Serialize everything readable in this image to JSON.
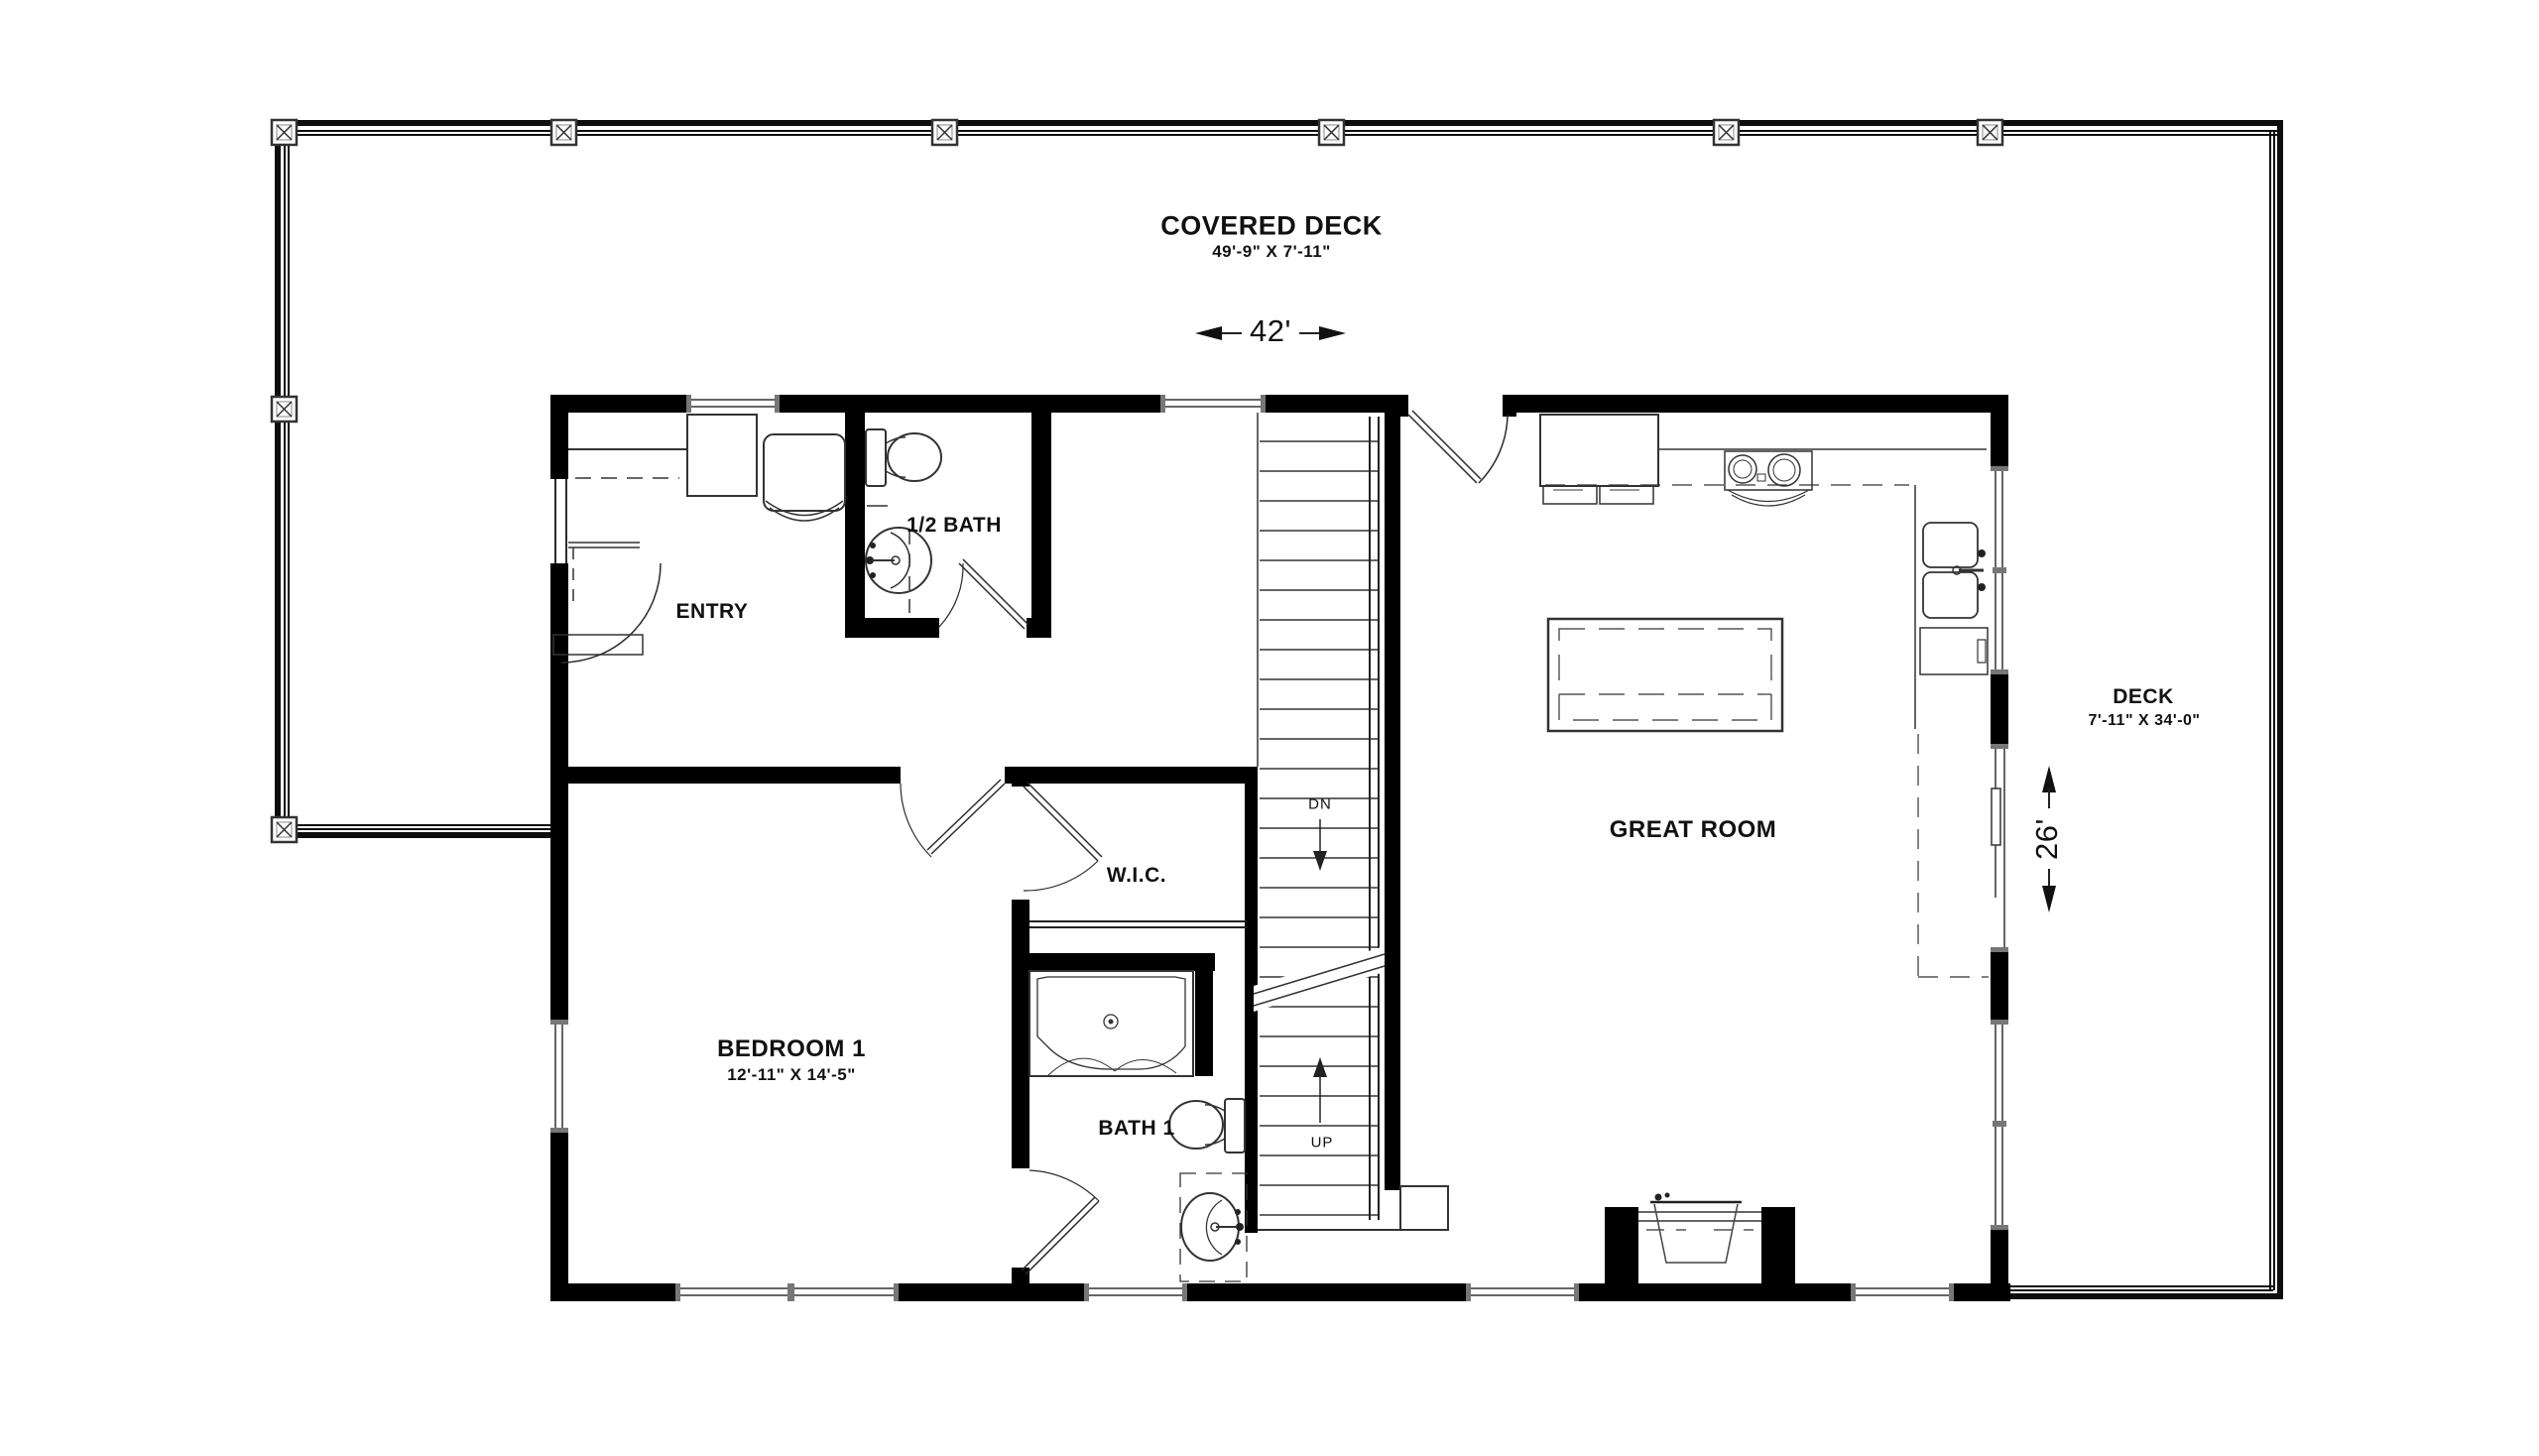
{
  "plan": {
    "title": "First floor plan",
    "labels": {
      "covered_deck": "COVERED DECK",
      "covered_deck_dims": "49'-9\" X 7'-11\"",
      "deck": "DECK",
      "deck_dims": "7'-11\" X 34'-0\"",
      "entry": "ENTRY",
      "half_bath": "1/2 BATH",
      "great_room": "GREAT ROOM",
      "wic": "W.I.C.",
      "bedroom1": "BEDROOM 1",
      "bedroom1_dims": "12'-11\" X 14'-5\"",
      "bath1": "BATH 1",
      "stairs_down": "DN",
      "stairs_up": "UP",
      "width_dim": "42'",
      "depth_dim": "26'"
    },
    "fixtures": [
      "refrigerator",
      "range",
      "kitchen-sink",
      "dishwasher",
      "kitchen-island",
      "half-bath-toilet",
      "pedestal-sink",
      "entry-closet",
      "armchair",
      "shower",
      "bath1-toilet",
      "vanity-sink",
      "wood-stove-fireplace",
      "stair-treads",
      "deck-posts",
      "sliding-glass-door"
    ],
    "colors": {
      "wall": "#000000",
      "line": "#2a2a2a",
      "background": "#ffffff"
    }
  }
}
